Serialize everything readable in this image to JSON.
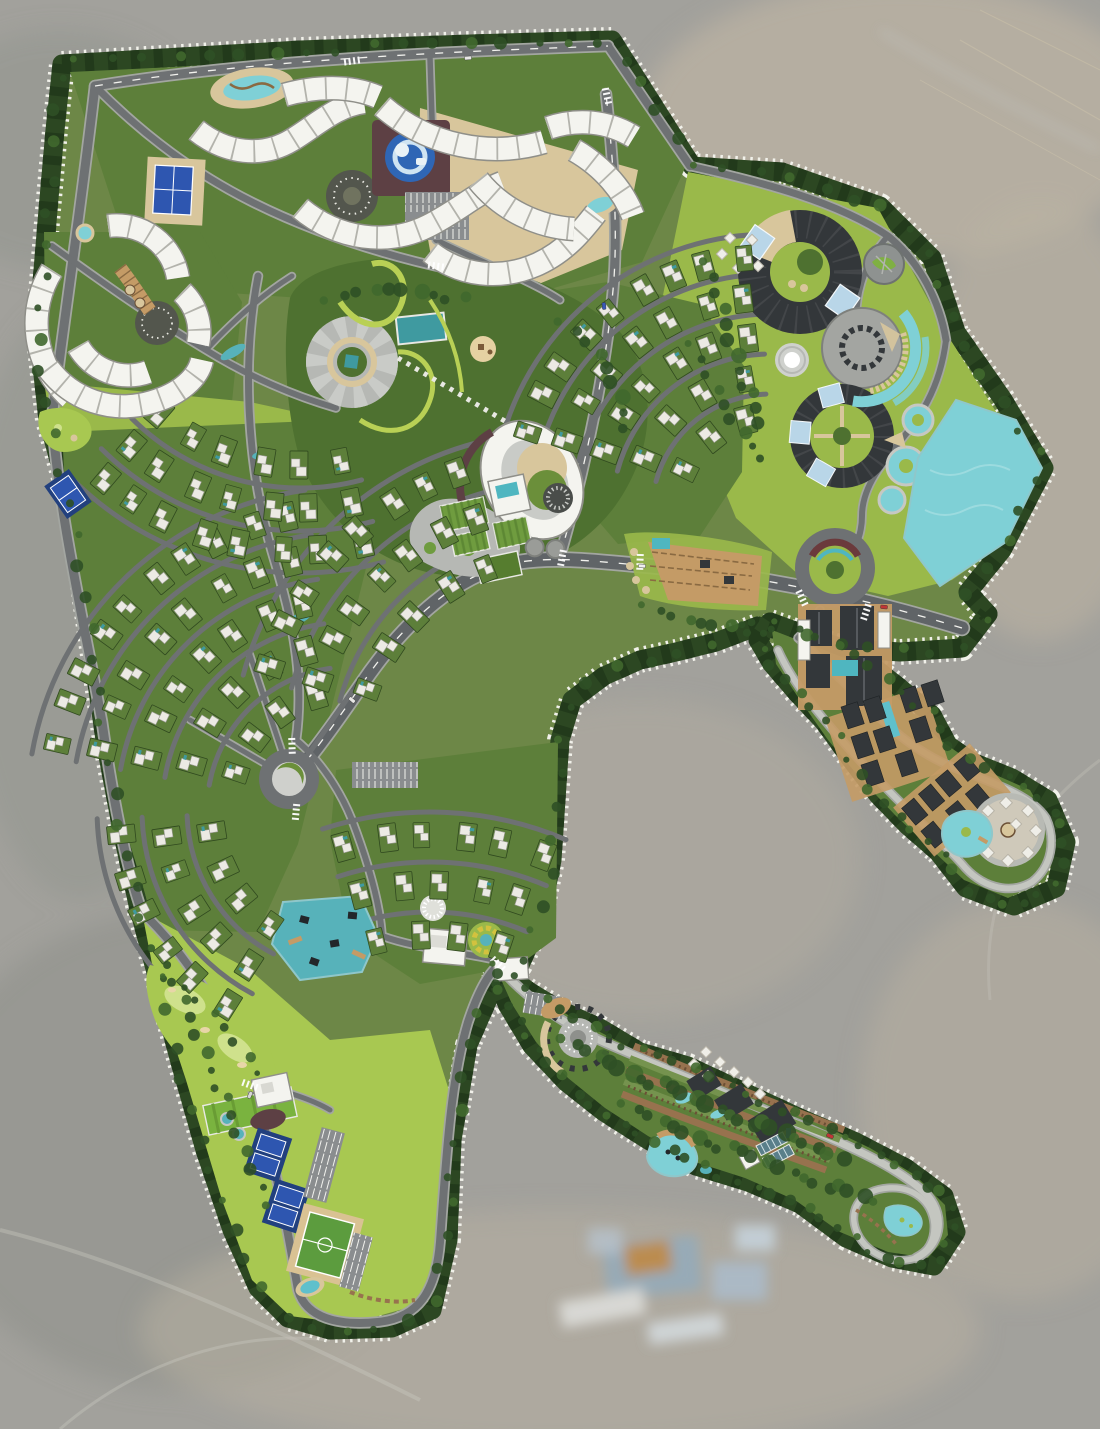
{
  "image": {
    "kind": "resort-master-plan-aerial-rendering",
    "width": 1100,
    "height": 1429,
    "visible_text": "none"
  },
  "palette": {
    "aerial-bg": "#a2a19c",
    "aerial-light": "#bab2a2",
    "aerial-dark": "#8d9089",
    "aerial-blue": "#93aabb",
    "aerial-orange": "#c08a42",
    "site-base": "#6d8747",
    "buffer": "#2c4722",
    "buffer-dark": "#223a1b",
    "stitch": "#f1f1ea",
    "road": "#6e7173",
    "arterial": "#606467",
    "curb": "#a3a6a1",
    "centerline": "#f2f2ee",
    "path-light": "#c4c6c0",
    "park": "#4e7130",
    "lawn": "#9ab94a",
    "golf": "#a8c851",
    "golf-light": "#cfe18c",
    "field-green": "#6f9c3f",
    "garden": "#5d7f3a",
    "hedge": "#30491f",
    "villa-white": "#eceae4",
    "villa-edge": "#9a9a93",
    "hotel-white": "#f4f4ef",
    "hotel-outline": "#8f8f89",
    "hotel-tick": "#b3b3ac",
    "sand": "#d8c69c",
    "boardwalk": "#c49b66",
    "deck-brown": "#8a6a42",
    "cyan": "#7fd0d6",
    "cyan-deep": "#57b2ba",
    "teal": "#3f9aa0",
    "pool-blue": "#2f66b5",
    "court-blue": "#2e56b0",
    "court-pad": "#22407e",
    "dark-roof": "#33373a",
    "glass": "#b9d6e8",
    "maroon": "#5d4044",
    "amphi-maroon": "#6b3a3c",
    "farm-brown": "#97724e",
    "soil": "#6b4f35",
    "plaza-gray": "#b6b8b4",
    "plaza-light": "#c9cbc7",
    "plaza-dark": "#53564d",
    "stone": "#8e9290",
    "track": "#d9c293",
    "pitch": "#5c9c3e",
    "tree-a": "#2f5026",
    "tree-b": "#40682e",
    "white": "#ffffff",
    "lot-gray": "#8a8d8f"
  },
  "zones": [
    {
      "name": "perimeter-tree-buffer",
      "color": "buffer"
    },
    {
      "name": "stitched-boundary-line",
      "color": "stitch"
    },
    {
      "name": "hotel-serpentine-buildings",
      "color": "hotel-white"
    },
    {
      "name": "villa-residential-fans",
      "color": "garden"
    },
    {
      "name": "central-park",
      "color": "park"
    },
    {
      "name": "ring-venue-complex",
      "color": "dark-roof"
    },
    {
      "name": "northeast-lake",
      "color": "cyan"
    },
    {
      "name": "southwest-lake",
      "color": "cyan-deep"
    },
    {
      "name": "kids-water-play",
      "color": "pool-blue"
    },
    {
      "name": "golf-course",
      "color": "golf"
    },
    {
      "name": "tennis-courts",
      "color": "court-blue"
    },
    {
      "name": "soccer-field",
      "color": "pitch"
    },
    {
      "name": "farm-terrace-arm",
      "color": "farm-brown"
    },
    {
      "name": "glamping-arm",
      "color": "boardwalk"
    },
    {
      "name": "pergola-terrace",
      "color": "boardwalk"
    },
    {
      "name": "community-farm",
      "color": "field-green"
    },
    {
      "name": "aerial-photo-background",
      "color": "aerial-bg"
    }
  ],
  "inventory": {
    "hotel_serpentine_buildings": 13,
    "villa_fan_clusters": 6,
    "villa_lots_approx": 140,
    "ring_venue_buildings": 2,
    "event_hall": 1,
    "fountain_plaza": 1,
    "stone_garden_circle": 1,
    "roundabouts": 2,
    "amphitheater_roundabout": 1,
    "spiral_event_plaza": 1,
    "tennis_court_pads": 3,
    "soccer_field": 1,
    "golf_course": 1,
    "driving_range": 1,
    "lakes": 2,
    "pools_and_ponds": 10,
    "lazy_river_pools": 3,
    "glamping_tents_approx": 25,
    "parking_lots": 6,
    "cars_visible": 7,
    "community_farm_plots": 4,
    "terrace_crop_bands": 5,
    "cabin_grids": 2
  },
  "geometry": {
    "boundaries": [
      {
        "name": "main-site",
        "d": "M62,64 L300,50 L470,44 L612,40 L692,166 L782,172 L880,206 L932,258 L956,332 L1002,398 L1044,468 L1002,550 L968,592 L988,614 L962,648 L900,652 L842,648 L800,634 L758,626 L716,642 L676,652 L640,660 L604,676 L572,700 L560,740 L556,800 L552,860 L540,920 L520,965 L492,990 L468,1045 L452,1140 L448,1240 L432,1310 L392,1328 L330,1330 L288,1318 L258,1288 L232,1230 L205,1150 L180,1062 L158,980 L138,905 L122,830 L105,740 L88,620 L70,500 L48,420 L38,330 L48,210 L55,130 Z"
      },
      {
        "name": "right-arm",
        "d": "M770,622 L820,640 L862,658 L900,688 L932,715 L948,745 L972,762 L1012,778 L1048,800 L1066,842 L1056,888 L1014,906 L966,888 L938,852 L908,826 L878,795 L850,758 L824,722 L796,692 L772,664 L758,640 Z"
      },
      {
        "name": "bottom-arm",
        "d": "M490,962 L530,992 L560,1010 L600,1028 L640,1052 L688,1066 L744,1092 L800,1118 L856,1142 L906,1168 L944,1196 L956,1232 L934,1266 L892,1258 L846,1238 L800,1204 L748,1182 L696,1166 L648,1140 L604,1112 L566,1082 L532,1046 L508,1006 Z"
      }
    ],
    "underlays": [
      {
        "name": "hotel-north-lawn",
        "fill": "garden",
        "d": "M70,72 L610,46 L686,166 L642,262 L520,298 L360,302 L215,292 L118,220 Z"
      },
      {
        "name": "hotel-north-sand",
        "fill": "sand",
        "d": "M420,108 L638,170 L622,250 L524,290 L432,262 L418,182 Z"
      },
      {
        "name": "sw-hotel-lawn",
        "fill": "garden",
        "d": "M44,232 L200,232 L242,302 L232,402 L178,432 L88,442 L46,380 Z"
      },
      {
        "name": "bright-lawn-west",
        "fill": "lawn",
        "d": "M44,382 L250,402 L342,422 L352,472 L240,474 L118,462 L52,432 Z"
      },
      {
        "name": "east-lobe-lawn",
        "fill": "lawn",
        "d": "M688,172 L878,208 L948,336 L1000,418 L1036,470 L998,548 L952,580 L888,596 L800,576 L736,518 L696,420 L662,300 Z"
      },
      {
        "name": "residential-west",
        "fill": "garden",
        "d": "M62,432 L335,420 L368,560 L332,706 L298,844 L258,932 L156,930 L104,758 L70,580 Z"
      },
      {
        "name": "residential-ne",
        "fill": "garden",
        "d": "M492,300 L608,282 L700,304 L744,366 L742,472 L700,536 L618,544 L556,472 L502,382 Z"
      },
      {
        "name": "residential-south",
        "fill": "garden",
        "d": "M336,770 L558,742 L556,938 L518,966 L420,984 L350,938 L330,840 Z"
      },
      {
        "name": "central-park",
        "fill": "park",
        "d": "M290,298 C302,268 360,256 420,258 C498,260 576,290 618,330 C650,362 654,418 640,458 C622,508 592,538 552,558 C504,582 444,582 402,564 C352,544 312,500 298,452 C286,408 282,344 290,298 Z"
      },
      {
        "name": "leg-lawn",
        "fill": "golf",
        "d": "M142,912 L250,970 L330,1040 L430,1030 L452,1100 L446,1240 L428,1302 L350,1324 L290,1316 L252,1280 L222,1200 L186,1080 L158,995 Z"
      },
      {
        "name": "arm-right-green",
        "fill": "garden",
        "d": "M772,630 L850,660 L900,700 L940,740 L980,768 L1030,790 L1056,836 L1046,880 L1008,898 L964,880 L930,848 L895,815 L860,778 L828,740 L800,700 L776,664 Z"
      },
      {
        "name": "arm-bottom-green",
        "fill": "garden",
        "d": "M495,966 L540,1000 L600,1032 L650,1058 L700,1072 L760,1098 L820,1124 L870,1148 L915,1175 L945,1205 L948,1235 L928,1258 L888,1252 L840,1232 L795,1200 L745,1178 L695,1162 L648,1136 L605,1108 L568,1078 L536,1042 L512,1004 Z"
      }
    ],
    "roads": [
      {
        "name": "north-arterial",
        "d": "M95,86 C240,62 430,52 608,46",
        "w": 9,
        "dash": true
      },
      {
        "name": "ne-diagonal",
        "d": "M608,46 L690,166",
        "w": 8
      },
      {
        "name": "ne-boundary-road",
        "d": "M690,166 C762,182 838,202 888,236 C920,262 940,302 946,340",
        "w": 7
      },
      {
        "name": "lobe-loop-road",
        "d": "M946,340 C940,390 918,420 898,444 C878,468 862,490 862,516 C862,540 850,560 836,570",
        "w": 6
      },
      {
        "name": "ring-access",
        "d": "M888,236 C864,262 852,300 858,338",
        "w": 5.5
      },
      {
        "name": "main-arterial",
        "d": "M962,628 C870,600 770,578 672,568 C600,562 560,556 520,562 C460,570 404,622 362,684 C332,728 310,758 291,779",
        "w": 13,
        "major": true,
        "dash": true
      },
      {
        "name": "north-branch",
        "d": "M560,556 C585,470 608,360 614,278 C618,218 612,148 606,94",
        "w": 9,
        "dash": true
      },
      {
        "name": "west-spine",
        "d": "M95,86 C82,200 64,320 52,418 C60,520 82,612 102,722 C114,806 128,872 142,912",
        "w": 9
      },
      {
        "name": "golf-road",
        "d": "M142,912 C184,952 224,1012 250,1082 C272,1142 288,1232 298,1290 C306,1318 338,1326 378,1322 C418,1318 436,1292 440,1242 C446,1162 450,1082 468,1022 C478,992 488,974 498,966",
        "w": 8
      },
      {
        "name": "arm-bottom-path",
        "d": "M498,966 C528,1000 566,1026 608,1044 C668,1070 738,1098 798,1124 C848,1146 898,1166 928,1196 C946,1218 940,1246 916,1258",
        "w": 7,
        "light": true
      },
      {
        "name": "tip-loop-path",
        "d": "M916,1258 C890,1266 864,1252 856,1230 C848,1208 862,1190 888,1188 C914,1186 932,1202 934,1224 C935,1240 928,1252 916,1258",
        "w": 5.5,
        "light": true
      },
      {
        "name": "arm-right-path",
        "d": "M798,638 C824,662 850,688 876,714 C898,736 922,754 950,766 C990,782 1030,794 1046,818 C1056,840 1052,866 1032,882 C1008,896 980,886 962,864 C944,844 920,822 898,800 C870,772 842,742 818,712 C800,690 786,668 778,650",
        "w": 6,
        "light": true
      },
      {
        "name": "arm-right-stub",
        "d": "M820,610 C812,622 804,632 798,638",
        "w": 6
      },
      {
        "name": "hotel-road-1",
        "d": "M95,86 C140,132 192,172 252,202 C322,237 392,257 452,270",
        "w": 7
      },
      {
        "name": "hotel-road-2",
        "d": "M52,246 C102,282 152,318 206,350 C248,376 294,396 336,408",
        "w": 6
      },
      {
        "name": "hotel-cross",
        "d": "M206,350 C232,322 260,296 292,276",
        "w": 5
      },
      {
        "name": "top-vertical",
        "d": "M430,58 C432,120 434,180 436,240",
        "w": 5.5
      },
      {
        "name": "park-east-link",
        "d": "M436,240 C480,262 530,280 560,300",
        "w": 5.5
      },
      {
        "name": "park-west-ring",
        "d": "M258,276 C242,360 246,462 272,552 C288,606 306,668 296,740",
        "w": 7
      },
      {
        "name": "south-connector",
        "d": "M296,740 C320,760 340,790 352,820 C368,862 380,902 382,936",
        "w": 6
      },
      {
        "name": "lake-link",
        "d": "M382,936 C420,950 470,952 520,966",
        "w": 6
      },
      {
        "name": "hub-spoke-1",
        "d": "M291,779 L250,655",
        "w": 5
      },
      {
        "name": "hub-spoke-2",
        "d": "M291,779 L190,720",
        "w": 5
      },
      {
        "name": "hub-spoke-3",
        "d": "M291,779 L352,692",
        "w": 5
      },
      {
        "name": "golf-east-link",
        "d": "M250,1082 C280,1090 310,1098 330,1110",
        "w": 5
      }
    ],
    "fans": [
      {
        "name": "villa-fan-west-1",
        "cx": 350,
        "cy": 810,
        "radii": [
          120,
          165,
          210,
          255,
          300
        ],
        "a0": 190,
        "a1": 262
      },
      {
        "name": "villa-fan-west-2",
        "cx": 300,
        "cy": 250,
        "radii": [
          215,
          258,
          300
        ],
        "a0": 75,
        "a1": 135
      },
      {
        "name": "villa-fan-west-3",
        "cx": 350,
        "cy": 810,
        "radii": [
          140,
          185,
          230
        ],
        "a0": 118,
        "a1": 178
      },
      {
        "name": "villa-fan-mid",
        "cx": 560,
        "cy": 760,
        "radii": [
          205,
          255,
          305
        ],
        "a0": 195,
        "a1": 255
      },
      {
        "name": "villa-fan-ne",
        "cx": 770,
        "cy": 512,
        "radii": [
          95,
          135,
          175,
          215,
          255
        ],
        "a0": 195,
        "a1": 268
      },
      {
        "name": "villa-fan-south",
        "cx": 430,
        "cy": 1160,
        "radii": [
          225,
          275,
          325
        ],
        "a0": 252,
        "a1": 293
      }
    ],
    "hotels": [
      "M196,130 C226,154 262,158 292,140 C318,124 336,106 364,102",
      "M284,95 C316,86 350,85 378,97",
      "M382,106 C428,146 490,158 544,142",
      "M548,128 C578,118 608,121 634,137",
      "M574,150 C604,167 624,192 633,216",
      "M300,208 C338,240 388,246 428,226 C458,211 478,192 502,183",
      "M430,252 C460,276 500,281 538,264 C566,251 582,231 596,213",
      "M478,180 C502,210 538,227 574,229",
      "M108,226 A62,62 0 0 1 178,278",
      "M52,270 A100,100 0 0 0 70,398",
      "M78,346 A58,58 0 0 0 148,372",
      "M48,368 C72,400 112,414 152,402 C180,394 198,378 202,360",
      "M182,292 A55,55 0 0 1 198,344"
    ],
    "tree_lines": [
      {
        "d": "M62,64 L300,50 L470,44 L612,40 L692,166 L782,172 L880,206 L932,258 L956,332 L1002,398 L1044,468 L1002,550 L968,592 L988,614 L962,648 L900,652 L842,648 L800,634 L758,626 L716,642 L676,652 L640,660 L604,676 L572,700 L560,740 L556,800 L552,860 L540,920 L520,965 L492,990 L468,1045 L452,1140 L448,1240 L432,1310 L392,1328 L330,1330 L288,1318 L258,1288 L232,1230 L205,1150 L180,1062 L158,980 L138,905 L122,830 L105,740 L88,620 L70,500 L48,420 L38,330 L48,210 L55,130 Z",
        "n": 120,
        "r": 5
      },
      {
        "d": "M770,622 L820,640 L862,658 L900,688 L932,715 L948,745 L972,762 L1012,778 L1048,800 L1066,842 L1056,888 L1014,906 L966,888 L938,852 L908,826 L878,795 L850,758 L824,722 L796,692 L772,664 L758,640 Z",
        "n": 44,
        "r": 4.5
      },
      {
        "d": "M490,962 L530,992 L560,1010 L600,1028 L640,1052 L688,1066 L744,1092 L800,1118 L856,1142 L906,1168 L944,1196 L956,1232 L934,1266 L892,1258 L846,1238 L800,1204 L748,1182 L696,1166 L648,1140 L604,1112 L566,1082 L532,1046 L508,1006 Z",
        "n": 62,
        "r": 4.5
      },
      {
        "d": "M560,1040 C640,1078 740,1118 845,1158",
        "n": 26,
        "r": 7
      },
      {
        "d": "M620,1105 C700,1140 790,1170 880,1205",
        "n": 22,
        "r": 6
      },
      {
        "d": "M322,308 C366,284 424,282 470,304",
        "n": 10,
        "r": 6
      },
      {
        "d": "M556,322 C600,344 622,388 628,432",
        "n": 9,
        "r": 6
      },
      {
        "d": "M706,258 C724,326 744,384 766,432",
        "n": 12,
        "r": 6
      },
      {
        "d": "M690,340 C710,390 736,430 770,460",
        "n": 9,
        "r": 5
      },
      {
        "d": "M640,606 C684,626 724,630 762,616",
        "n": 9,
        "r": 5
      },
      {
        "d": "M152,944 C192,1014 232,1114 268,1212",
        "n": 16,
        "r": 5
      },
      {
        "d": "M160,975 C200,1000 240,1040 262,1078",
        "n": 8,
        "r": 4
      }
    ],
    "crosswalks": [
      {
        "x": 352,
        "y": 61,
        "rot": -8
      },
      {
        "x": 607,
        "y": 96,
        "rot": 78
      },
      {
        "x": 436,
        "y": 266,
        "rot": 8
      },
      {
        "x": 292,
        "y": 746,
        "rot": 88
      },
      {
        "x": 296,
        "y": 812,
        "rot": 95
      },
      {
        "x": 802,
        "y": 598,
        "rot": 65
      },
      {
        "x": 866,
        "y": 612,
        "rot": -72
      },
      {
        "x": 498,
        "y": 964,
        "rot": 45
      },
      {
        "x": 562,
        "y": 558,
        "rot": 100
      },
      {
        "x": 640,
        "y": 562,
        "rot": 92
      },
      {
        "x": 250,
        "y": 1085,
        "rot": 20
      }
    ],
    "cars": [
      {
        "x": 468,
        "y": 58,
        "rot": -5,
        "c": "#e8e8e6"
      },
      {
        "x": 642,
        "y": 566,
        "rot": 3,
        "c": "#f0f0ee"
      },
      {
        "x": 884,
        "y": 607,
        "rot": 5,
        "c": "#c03636"
      },
      {
        "x": 604,
        "y": 306,
        "rot": 85,
        "c": "#3858b8"
      },
      {
        "x": 352,
        "y": 700,
        "rot": 40,
        "c": "#e8e8e6"
      },
      {
        "x": 250,
        "y": 1095,
        "rot": -65,
        "c": "#d8d8d6"
      },
      {
        "x": 830,
        "y": 1136,
        "rot": 22,
        "c": "#c03636"
      }
    ]
  }
}
